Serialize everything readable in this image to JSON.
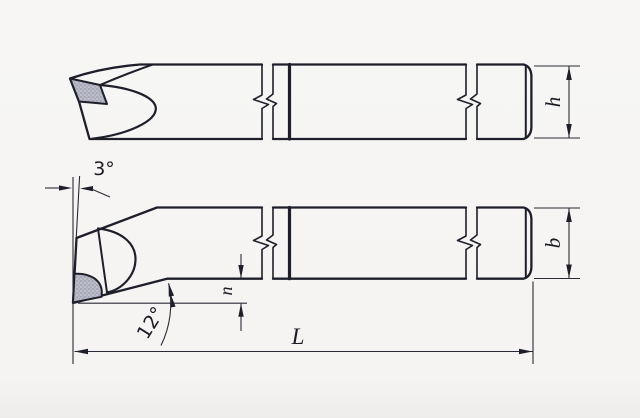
{
  "drawing": {
    "labels": {
      "shank_height": "h",
      "shank_width": "b",
      "overall_length": "L",
      "tip_offset": "n",
      "front_angle": "3°",
      "clearance_angle": "12°"
    },
    "colors": {
      "line": "#1f1f2b",
      "thin_line": "#2a2a36",
      "insert_fill": "#bdbeca",
      "insert_dot": "#7c7c90",
      "background": "#f6f5f3"
    }
  }
}
